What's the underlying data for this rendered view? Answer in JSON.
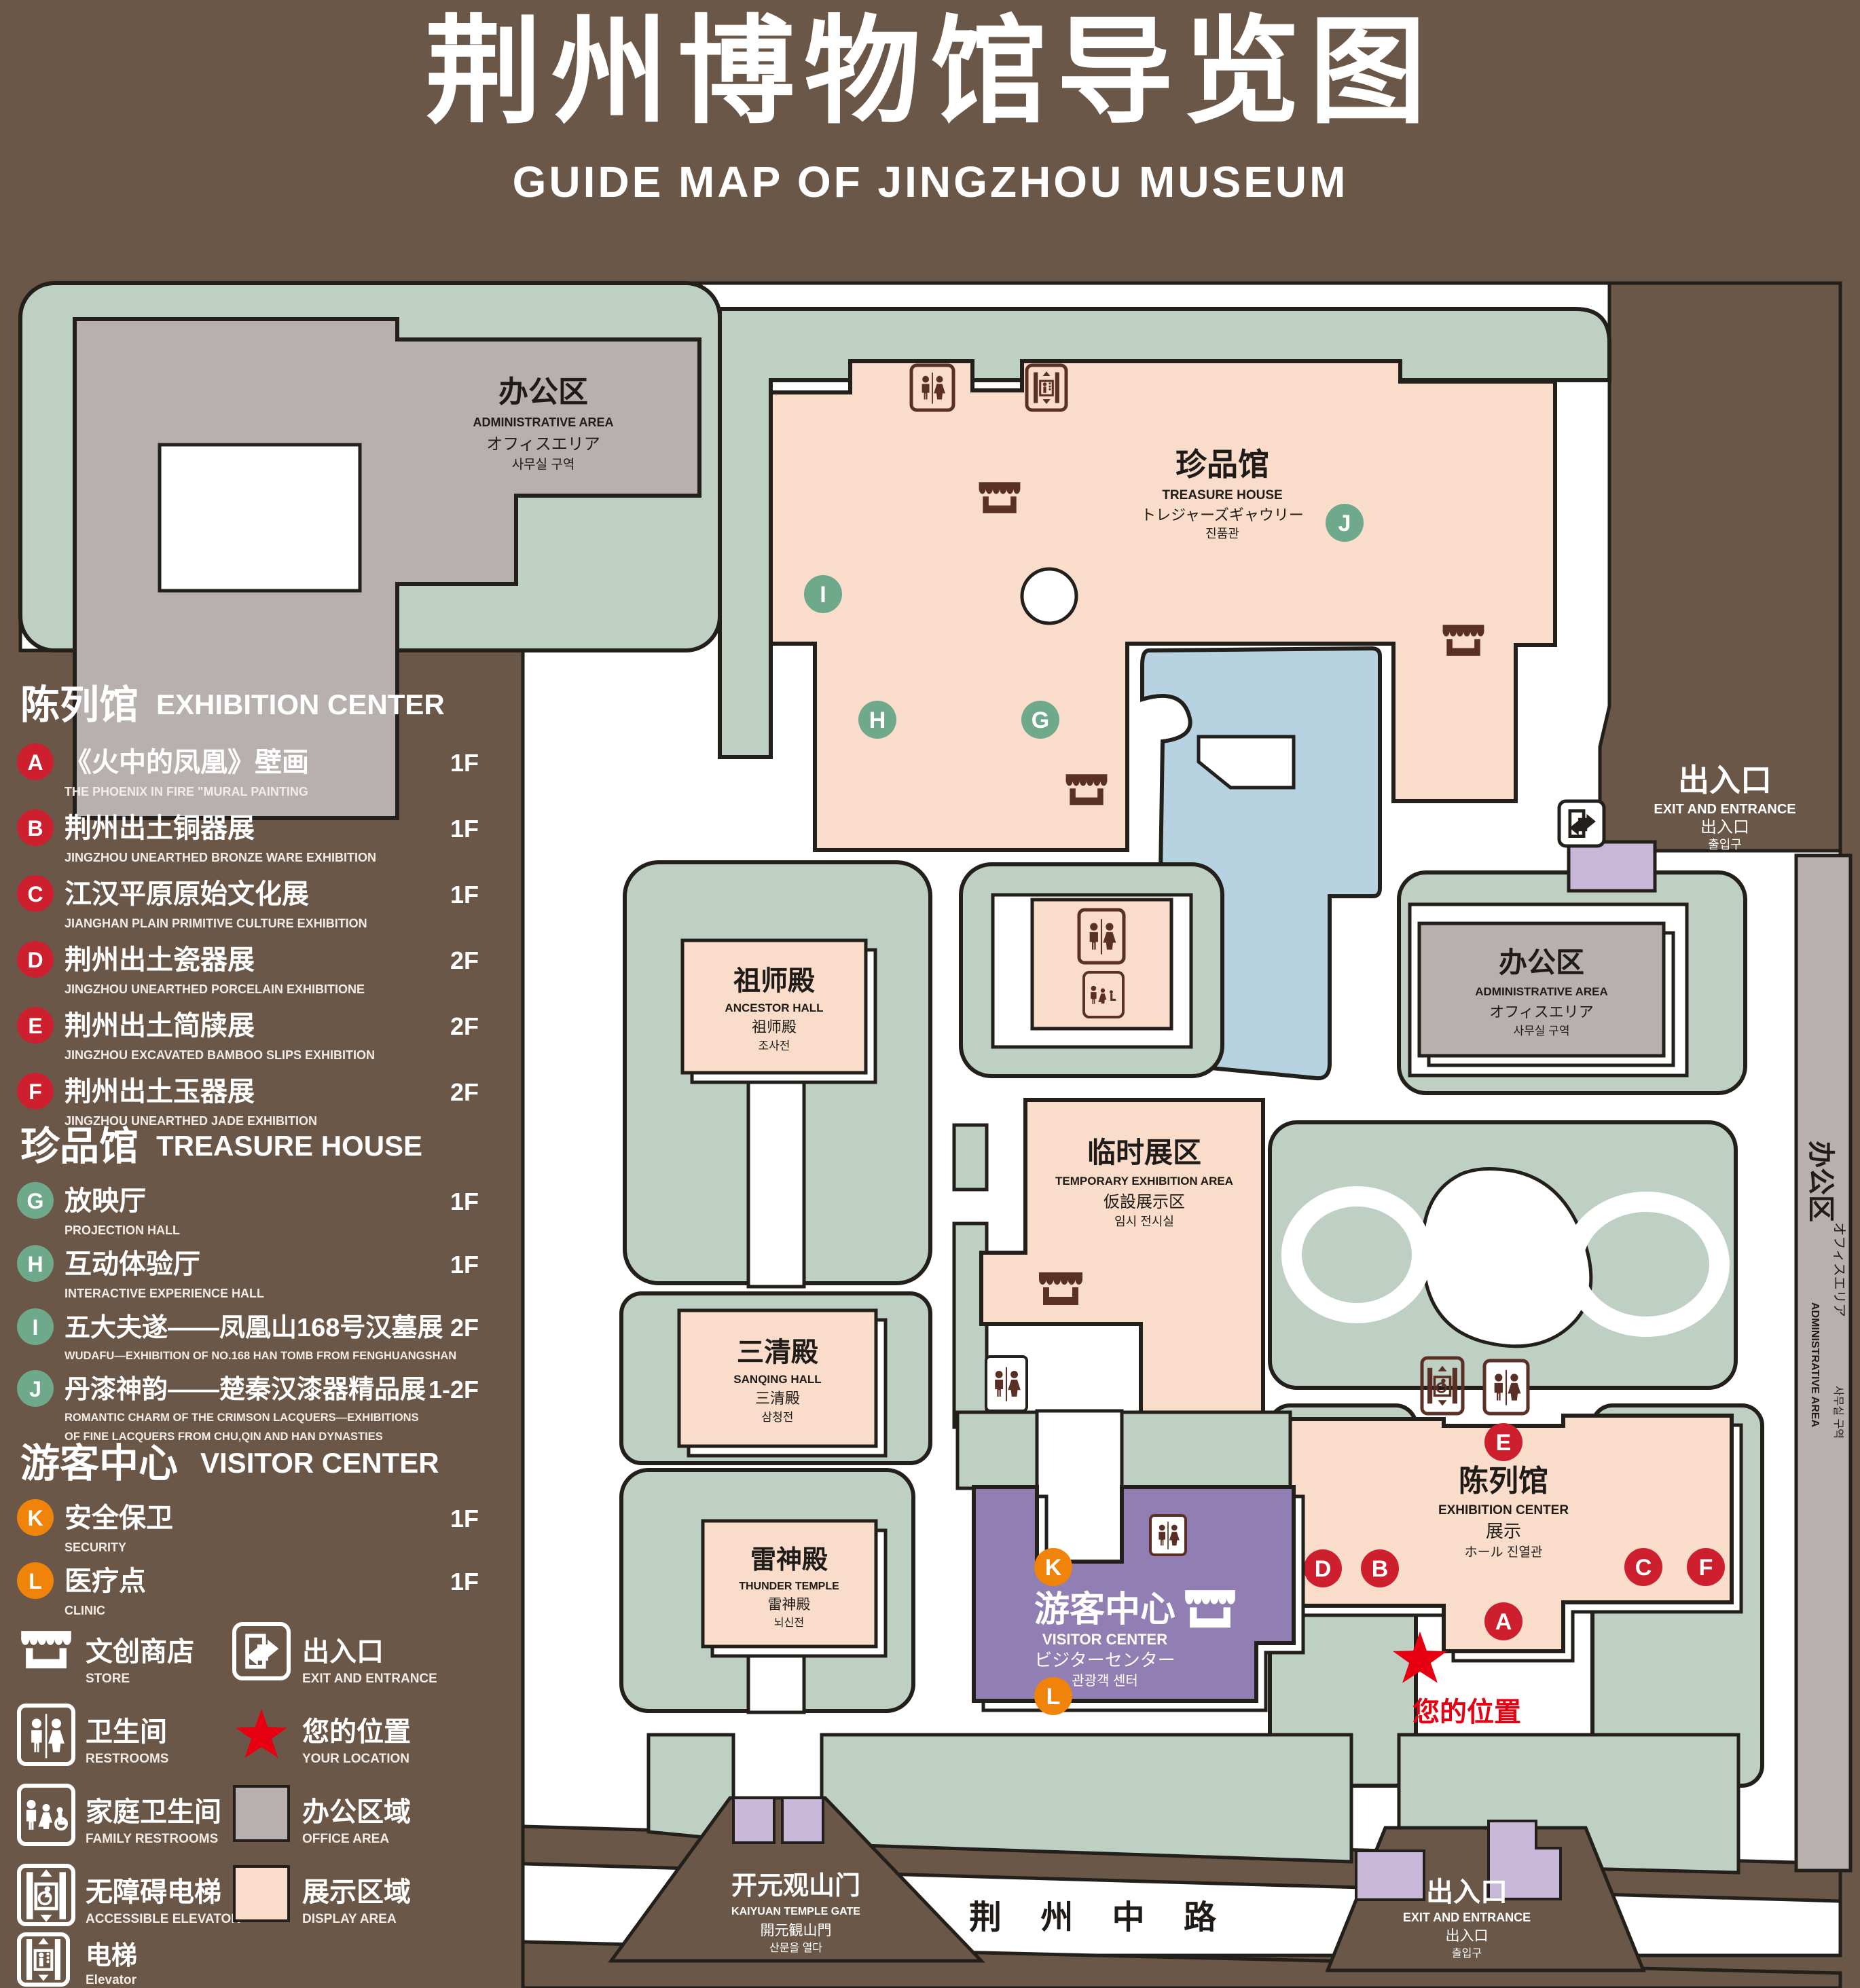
{
  "title": {
    "zh": "荆州博物馆导览图",
    "en": "GUIDE MAP OF JINGZHOU MUSEUM"
  },
  "colors": {
    "bg": "#6a5748",
    "green": "#bdd0c3",
    "pink": "#f9dcc9",
    "gray": "#b7b0ae",
    "blue": "#b7d3e2",
    "visitor_purple": "#917eb2",
    "light_purple": "#c9b7da",
    "red": "#ce1f2e",
    "green_badge": "#6fa98c",
    "orange": "#f0830a",
    "icon_brown": "#5a3026"
  },
  "legend": {
    "sections": [
      {
        "zh": "陈列馆",
        "en": "EXHIBITION CENTER",
        "items": [
          {
            "letter": "A",
            "zh": "《火中的凤凰》壁画",
            "en": "THE PHOENIX IN FIRE \"MURAL PAINTING",
            "floor": "1F"
          },
          {
            "letter": "B",
            "zh": "荆州出土铜器展",
            "en": "JINGZHOU UNEARTHED BRONZE WARE EXHIBITION",
            "floor": "1F"
          },
          {
            "letter": "C",
            "zh": "江汉平原原始文化展",
            "en": "JIANGHAN PLAIN PRIMITIVE CULTURE EXHIBITION",
            "floor": "1F"
          },
          {
            "letter": "D",
            "zh": "荆州出土瓷器展",
            "en": "JINGZHOU UNEARTHED PORCELAIN EXHIBITIONE",
            "floor": "2F"
          },
          {
            "letter": "E",
            "zh": "荆州出土简牍展",
            "en": "JINGZHOU EXCAVATED BAMBOO SLIPS EXHIBITION",
            "floor": "2F"
          },
          {
            "letter": "F",
            "zh": "荆州出土玉器展",
            "en": "JINGZHOU UNEARTHED JADE EXHIBITION",
            "floor": "2F"
          }
        ]
      },
      {
        "zh": "珍品馆",
        "en": "TREASURE HOUSE",
        "items": [
          {
            "letter": "G",
            "zh": "放映厅",
            "en": "PROJECTION HALL",
            "floor": "1F"
          },
          {
            "letter": "H",
            "zh": "互动体验厅",
            "en": "INTERACTIVE EXPERIENCE HALL",
            "floor": "1F"
          },
          {
            "letter": "I",
            "zh": "五大夫遂——凤凰山168号汉墓展",
            "en": "WUDAFU—EXHIBITION OF NO.168 HAN TOMB FROM FENGHUANGSHAN",
            "floor": "2F"
          },
          {
            "letter": "J",
            "zh": "丹漆神韵——楚秦汉漆器精品展",
            "en": "ROMANTIC CHARM OF THE CRIMSON LACQUERS—EXHIBITIONS",
            "en2": "OF FINE LACQUERS FROM CHU,QIN AND HAN DYNASTIES",
            "floor": "1-2F"
          }
        ]
      },
      {
        "zh": "游客中心",
        "en": "VISITOR CENTER",
        "items": [
          {
            "letter": "K",
            "zh": "安全保卫",
            "en": "SECURITY",
            "floor": "1F"
          },
          {
            "letter": "L",
            "zh": "医疗点",
            "en": "CLINIC",
            "floor": "1F"
          }
        ]
      }
    ],
    "symbols": [
      {
        "icon": "store-icon",
        "zh": "文创商店",
        "en": "STORE"
      },
      {
        "icon": "exit-icon",
        "zh": "出入口",
        "en": "EXIT AND ENTRANCE"
      },
      {
        "icon": "restrooms-icon",
        "zh": "卫生间",
        "en": "RESTROOMS"
      },
      {
        "icon": "location-star-icon",
        "zh": "您的位置",
        "en": "YOUR LOCATION"
      },
      {
        "icon": "family-restrooms-icon",
        "zh": "家庭卫生间",
        "en": "FAMILY RESTROOMS"
      },
      {
        "icon": "office-area-swatch",
        "zh": "办公区域",
        "en": "OFFICE AREA"
      },
      {
        "icon": "accessible-elevator-icon",
        "zh": "无障碍电梯",
        "en": "ACCESSIBLE ELEVATOR"
      },
      {
        "icon": "display-area-swatch",
        "zh": "展示区域",
        "en": "DISPLAY AREA"
      },
      {
        "icon": "elevator-icon",
        "zh": "电梯",
        "en": "Elevator"
      }
    ]
  },
  "map": {
    "admin": {
      "zh": "办公区",
      "en": "ADMINISTRATIVE AREA",
      "ja": "オフィスエリア",
      "ko": "사무실 구역"
    },
    "treasure": {
      "zh": "珍品馆",
      "en": "TREASURE HOUSE",
      "ja": "トレジャーズギャウリー",
      "ko": "진품관"
    },
    "exit": {
      "zh": "出入口",
      "en": "EXIT AND ENTRANCE",
      "zh2": "出入口",
      "ko": "출입구"
    },
    "ancestor": {
      "zh": "祖师殿",
      "en": "ANCESTOR HALL",
      "zh2": "祖师殿",
      "ko": "조사전"
    },
    "sanqing": {
      "zh": "三清殿",
      "en": "SANQING HALL",
      "zh2": "三清殿",
      "ko": "삼청전"
    },
    "thunder": {
      "zh": "雷神殿",
      "en": "THUNDER TEMPLE",
      "zh2": "雷神殿",
      "ko": "뇌신전"
    },
    "temporary": {
      "zh": "临时展区",
      "en": "TEMPORARY EXHIBITION AREA",
      "ja": "仮設展示区",
      "ko": "임시 전시실"
    },
    "exhibition": {
      "zh": "陈列馆",
      "en": "EXHIBITION CENTER",
      "zh2": "展示",
      "sub": "ホール 진열관"
    },
    "visitor": {
      "zh": "游客中心",
      "en": "VISITOR CENTER",
      "ja": "ビジターセンター",
      "ko": "관광객 센터"
    },
    "your_location": "您的位置",
    "gate": {
      "zh": "开元观山门",
      "en": "KAIYUAN TEMPLE GATE",
      "ja": "開元観山門",
      "ko": "산문을 열다"
    },
    "road": "荆 州 中 路"
  }
}
